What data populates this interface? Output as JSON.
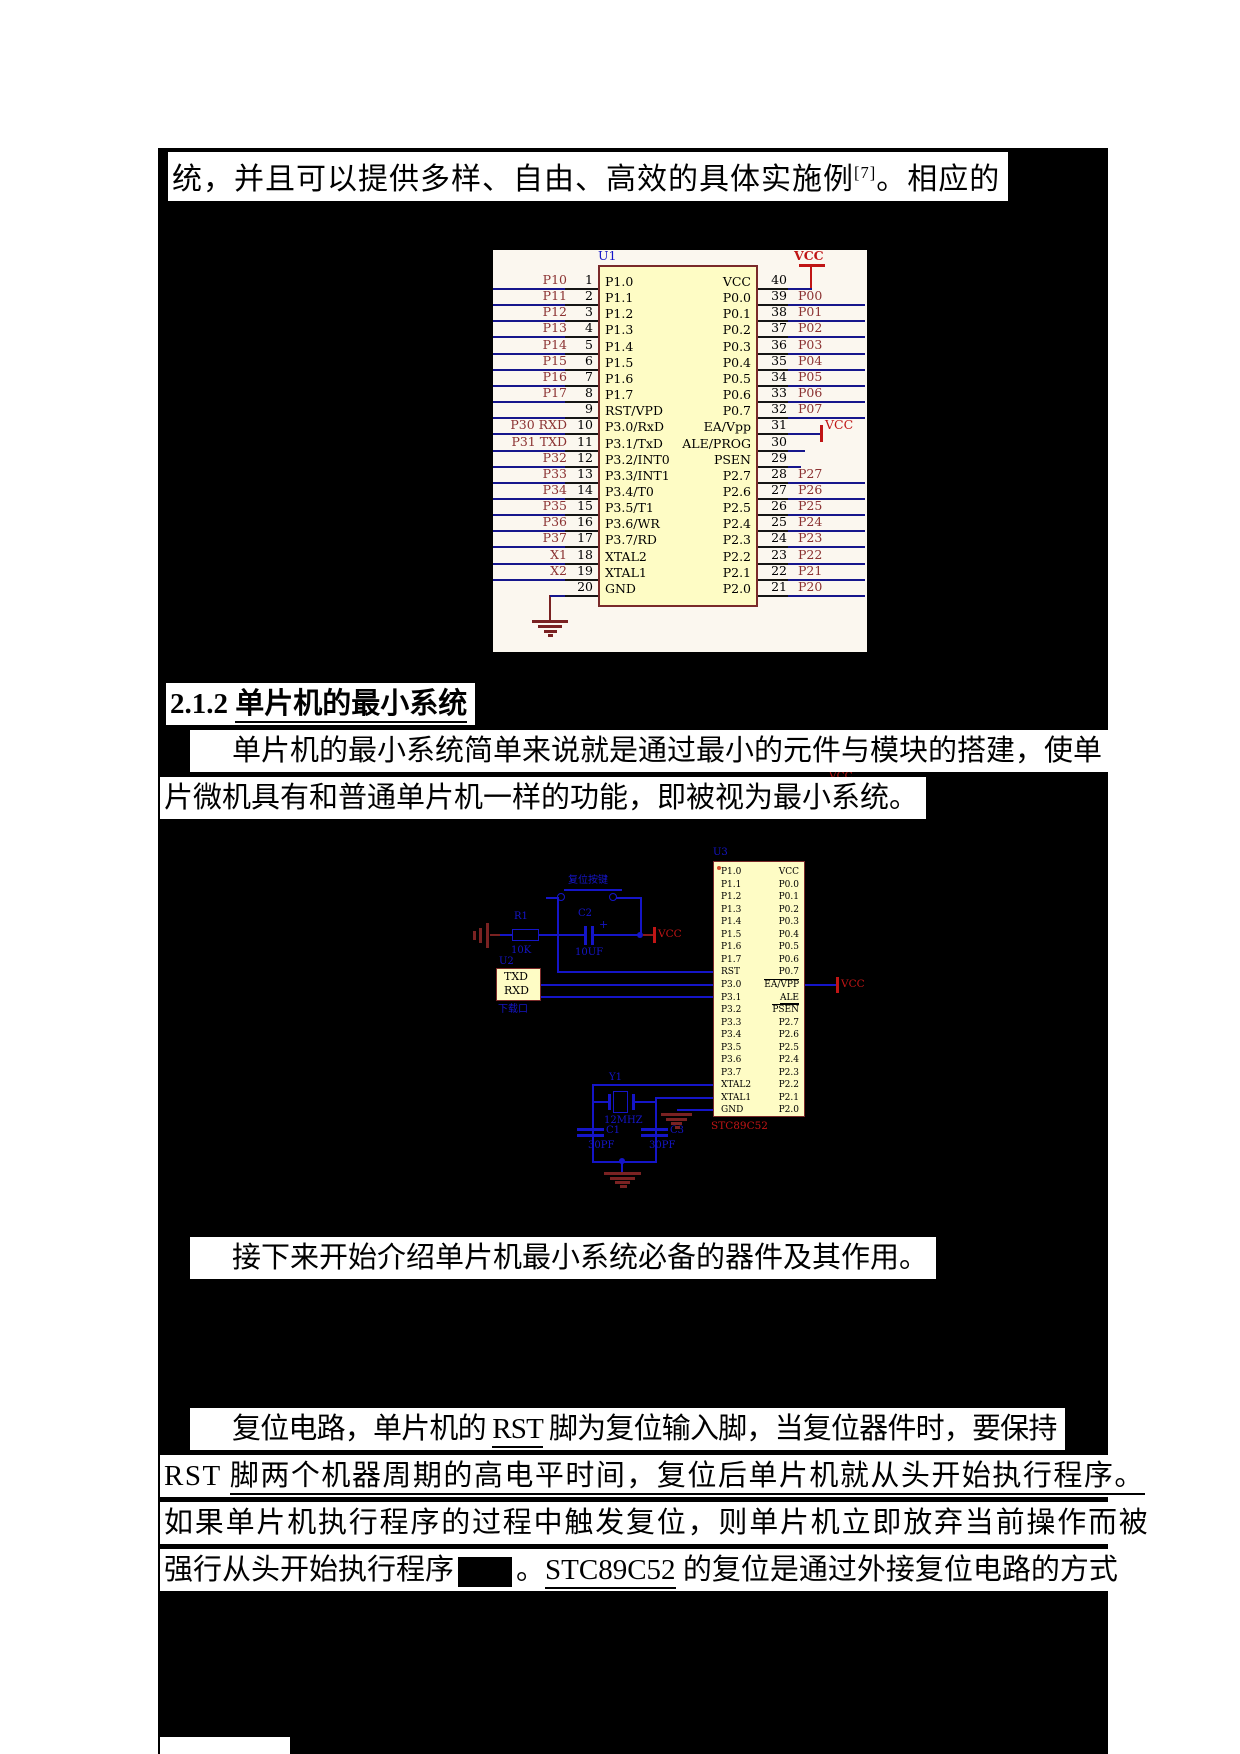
{
  "document": {
    "top_line": {
      "pre": "统，并且可以提供多样、自由、高效的具体实施例",
      "sup": "[7]",
      "post": "。相应的"
    },
    "heading": {
      "number": "2.1.2",
      "title": "单片机的最小系统"
    },
    "para1_line1": "单片机的最小系统简单来说就是通过最小的元件与模块的搭建，使单",
    "para1_line2": "片微机具有和普通单片机一样的功能，即被视为最小系统。",
    "para2_line": "接下来开始介绍单片机最小系统必备的器件及其作用。",
    "para3": {
      "l1_pre": "复位电路，单片机的 ",
      "l1_u": "RST",
      "l1_post": " 脚为复位输入脚，当复位器件时，要保持",
      "l2_pre": "RST ",
      "l2_u": "脚两个机器周期的高电平时间，复位后单片机就从头开始执行程序。",
      "l3": "如果单片机执行程序的过程中触发复位，则单片机立即放弃当前操作而被",
      "l4_pre": "强行从头开始执行程序",
      "l4_mid": "。",
      "l4_u": "STC89C52",
      "l4_post": " 的复位是通过外接复位电路的方式"
    }
  },
  "schematic1": {
    "designator": "U1",
    "vcc_top_label": "VCC",
    "vcc_right_label": "VCC",
    "pins": [
      {
        "l": "P10",
        "n": "1",
        "il": "P1.0",
        "ir": "VCC",
        "rn": "40",
        "r": ""
      },
      {
        "l": "P11",
        "n": "2",
        "il": "P1.1",
        "ir": "P0.0",
        "rn": "39",
        "r": "P00"
      },
      {
        "l": "P12",
        "n": "3",
        "il": "P1.2",
        "ir": "P0.1",
        "rn": "38",
        "r": "P01"
      },
      {
        "l": "P13",
        "n": "4",
        "il": "P1.3",
        "ir": "P0.2",
        "rn": "37",
        "r": "P02"
      },
      {
        "l": "P14",
        "n": "5",
        "il": "P1.4",
        "ir": "P0.3",
        "rn": "36",
        "r": "P03"
      },
      {
        "l": "P15",
        "n": "6",
        "il": "P1.5",
        "ir": "P0.4",
        "rn": "35",
        "r": "P04"
      },
      {
        "l": "P16",
        "n": "7",
        "il": "P1.6",
        "ir": "P0.5",
        "rn": "34",
        "r": "P05"
      },
      {
        "l": "P17",
        "n": "8",
        "il": "P1.7",
        "ir": "P0.6",
        "rn": "33",
        "r": "P06"
      },
      {
        "l": "",
        "n": "9",
        "il": "RST/VPD",
        "ir": "P0.7",
        "rn": "32",
        "r": "P07"
      },
      {
        "l": "P30 RXD",
        "n": "10",
        "il": "P3.0/RxD",
        "ir": "EA/Vpp",
        "rn": "31",
        "r": ""
      },
      {
        "l": "P31 TXD",
        "n": "11",
        "il": "P3.1/TxD",
        "ir": "ALE/PROG",
        "rn": "30",
        "r": ""
      },
      {
        "l": "P32",
        "n": "12",
        "il": "P3.2/INT0",
        "ir": "PSEN",
        "rn": "29",
        "r": ""
      },
      {
        "l": "P33",
        "n": "13",
        "il": "P3.3/INT1",
        "ir": "P2.7",
        "rn": "28",
        "r": "P27"
      },
      {
        "l": "P34",
        "n": "14",
        "il": "P3.4/T0",
        "ir": "P2.6",
        "rn": "27",
        "r": "P26"
      },
      {
        "l": "P35",
        "n": "15",
        "il": "P3.5/T1",
        "ir": "P2.5",
        "rn": "26",
        "r": "P25"
      },
      {
        "l": "P36",
        "n": "16",
        "il": "P3.6/WR",
        "ir": "P2.4",
        "rn": "25",
        "r": "P24"
      },
      {
        "l": "P37",
        "n": "17",
        "il": "P3.7/RD",
        "ir": "P2.3",
        "rn": "24",
        "r": "P23"
      },
      {
        "l": "X1",
        "n": "18",
        "il": "XTAL2",
        "ir": "P2.2",
        "rn": "23",
        "r": "P22"
      },
      {
        "l": "X2",
        "n": "19",
        "il": "XTAL1",
        "ir": "P2.1",
        "rn": "22",
        "r": "P21"
      },
      {
        "l": "",
        "n": "20",
        "il": "GND",
        "ir": "P2.0",
        "rn": "21",
        "r": "P20"
      }
    ]
  },
  "schematic2": {
    "designator": "U3",
    "part_number": "STC89C52",
    "vcc_top_label": "VCC",
    "vcc_ea_label": "VCC",
    "vcc_c2_label": "VCC",
    "reset_button_label": "复位按键",
    "r1": {
      "ref": "R1",
      "value": "10K"
    },
    "c2": {
      "ref": "C2",
      "value": "10UF",
      "plus": "+"
    },
    "u2": {
      "ref": "U2",
      "line1": "TXD",
      "line2": "RXD",
      "caption": "下载口"
    },
    "y1": {
      "ref": "Y1",
      "value": "12MHZ"
    },
    "c1": {
      "ref": "C1",
      "value": "30PF"
    },
    "c3": {
      "ref": "C3",
      "value": "30PF"
    },
    "pins_left": [
      "P1.0",
      "P1.1",
      "P1.2",
      "P1.3",
      "P1.4",
      "P1.5",
      "P1.6",
      "P1.7",
      "RST",
      "P3.0",
      "P3.1",
      "P3.2",
      "P3.3",
      "P3.4",
      "P3.5",
      "P3.6",
      "P3.7",
      "XTAL2",
      "XTAL1",
      "GND"
    ],
    "pins_right": [
      "VCC",
      "P0.0",
      "P0.1",
      "P0.2",
      "P0.3",
      "P0.4",
      "P0.5",
      "P0.6",
      "P0.7",
      "EA/VPP",
      "ALE",
      "PSEN",
      "P2.7",
      "P2.6",
      "P2.5",
      "P2.4",
      "P2.3",
      "P2.2",
      "P2.1",
      "P2.0"
    ]
  },
  "colors": {
    "wire_blue": "#1515C8",
    "wire_navy": "#16168C",
    "label_maroon": "#8B3232",
    "power_red": "#C01515",
    "ground_maroon": "#7A2222",
    "chip_yellow": "#FEFCC5"
  }
}
